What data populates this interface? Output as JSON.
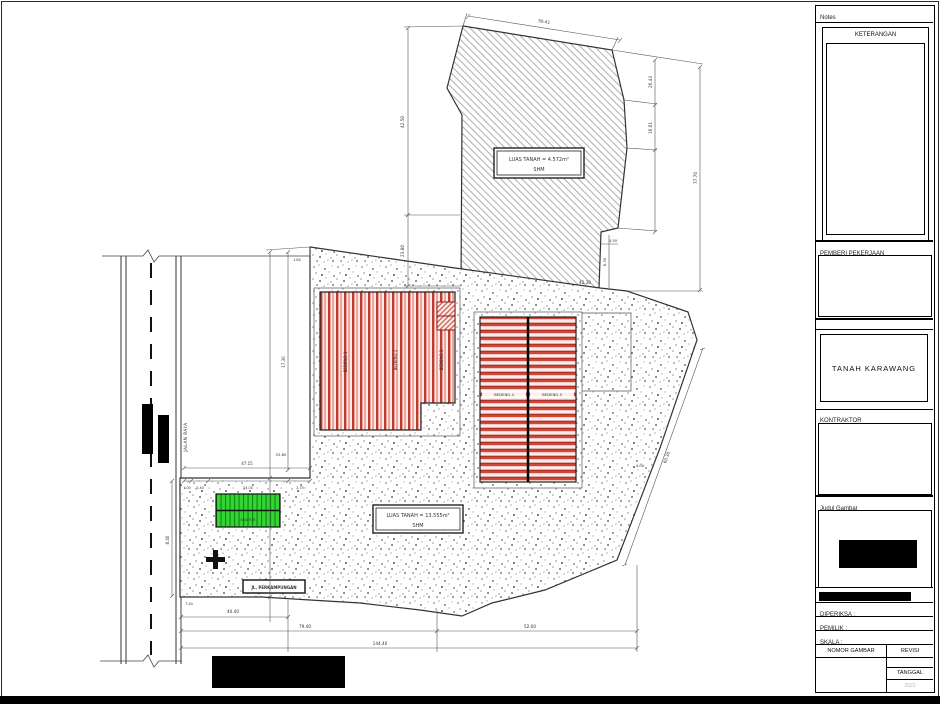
{
  "colors": {
    "line": "#2a2a2a",
    "building_red": "#c0392b",
    "building_red_light": "#e8938c",
    "building_green": "#2ed32e",
    "hatch_gray": "#9a9a9a",
    "redaction": "#000000"
  },
  "title_block": {
    "notes_label": "Notes",
    "keterangan_label": "KETERANGAN",
    "pemberi_pekerjaan_label": "PEMBERI PEKERJAAN",
    "project_title": "TANAH KARAWANG",
    "kontraktor_label": "KONTRAKTOR",
    "judul_gambar_label": "Judul Gambar",
    "diperiksa_label": "DIPERIKSA :",
    "pemilik_label": "PEMILIK :",
    "skala_label": "SKALA :",
    "nomor_gambar_label": "NOMOR GAMBAR",
    "revisi_label": "REVISI",
    "tanggal_label": "TANGGAL",
    "tanggal_value": "2021"
  },
  "drawing": {
    "labels": {
      "upper_parcel_line1": "LUAS TANAH = 4.572m²",
      "upper_parcel_line2": "SHM",
      "lower_parcel_line1": "LUAS TANAH = 13.555m²",
      "lower_parcel_line2": "SHM",
      "road": "JALAN RAYA",
      "street": "JL. PERKAMPUNGAN",
      "bedeng1": "BEDENG 1",
      "bedeng2": "BEDENG 2",
      "bedeng3": "BEDENG 3",
      "bedeng4": "BEDENG 4",
      "bedeng5": "BEDENG 5",
      "kantor": "KANTOR"
    },
    "dims": {
      "top_width": "56.41",
      "left_upper": "42.50",
      "left_lower": "23.80",
      "right_seg1": "26.44",
      "right_seg2": "16.01",
      "right_total": "77.70",
      "notch_w": "4.50",
      "notch_h": "6.30",
      "upper_bottom": "42.30",
      "top_left_small": "1.80",
      "lower_left_v1": "17.30",
      "lower_left_v2": "25.80",
      "left_chain_total": "47.15",
      "chain_1": "1.00",
      "chain_2": "5.40",
      "chain_3": "24.00",
      "chain_4": "2.75",
      "road_side": "8.40",
      "small_740": "7.40",
      "right_slope": "60.30",
      "small_400": "4.00",
      "bottom_1": "40.40",
      "bottom_2": "79.40",
      "bottom_3": "52.00",
      "bottom_total": "144.40"
    }
  }
}
